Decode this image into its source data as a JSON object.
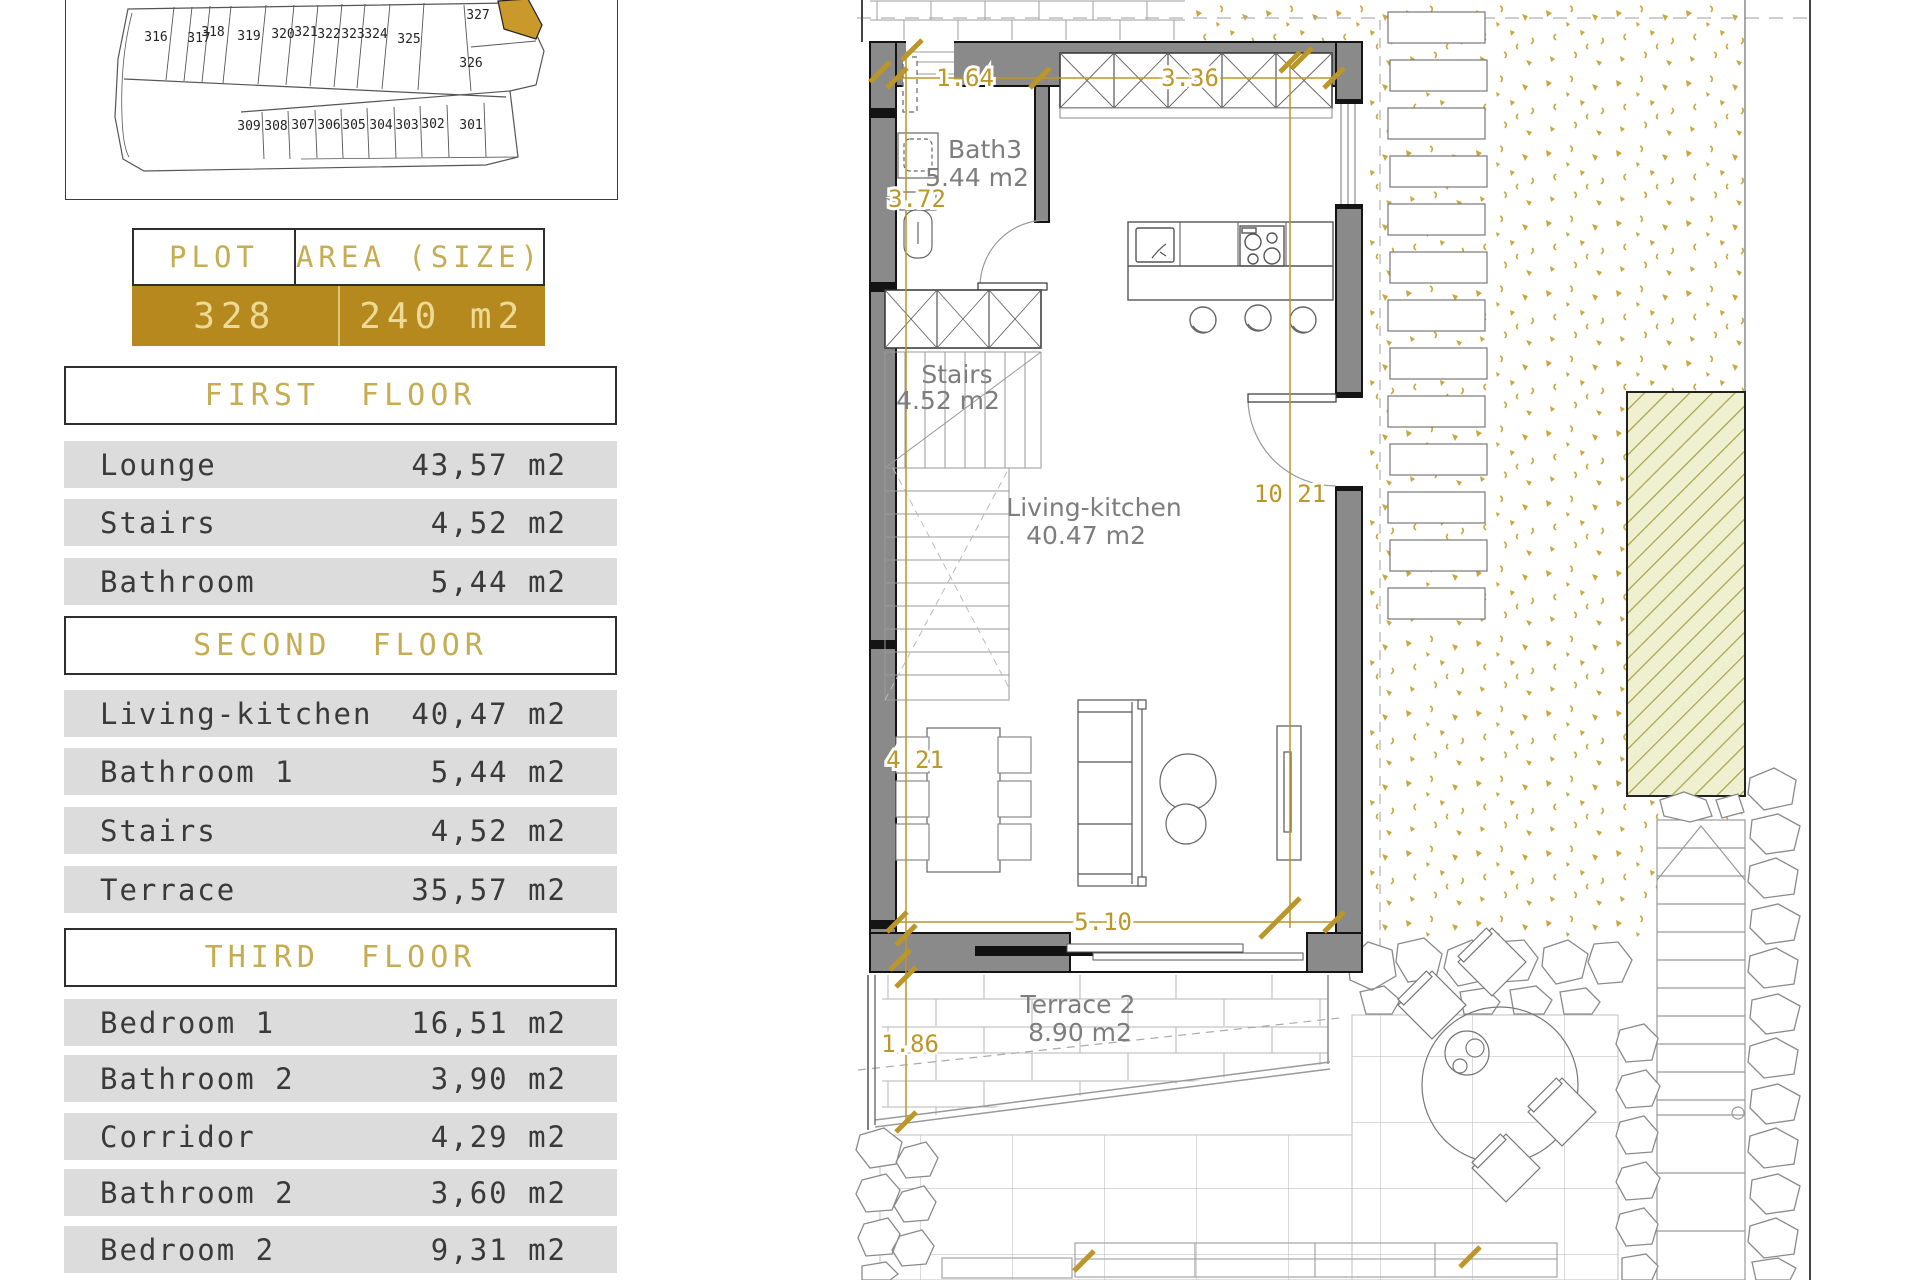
{
  "site_map": {
    "highlight_plot": "328",
    "top_row": [
      "316",
      "317",
      "318",
      "319",
      "320",
      "321",
      "322",
      "323",
      "324",
      "325"
    ],
    "upper_right": [
      "327",
      "326"
    ],
    "bottom_row": [
      "309",
      "308",
      "307",
      "306",
      "305",
      "304",
      "303",
      "302",
      "301"
    ]
  },
  "plot_table": {
    "col1_header": "PLOT",
    "col2_header": "AREA (SIZE)",
    "plot_number": "328",
    "area": "240 m2"
  },
  "floors": [
    {
      "title": "FIRST FLOOR",
      "rows": [
        {
          "name": "Lounge",
          "area": "43,57 m2"
        },
        {
          "name": "Stairs",
          "area": "4,52 m2"
        },
        {
          "name": "Bathroom",
          "area": "5,44 m2"
        }
      ]
    },
    {
      "title": "SECOND FLOOR",
      "rows": [
        {
          "name": "Living-kitchen",
          "area": "40,47 m2"
        },
        {
          "name": "Bathroom 1",
          "area": "5,44 m2"
        },
        {
          "name": "Stairs",
          "area": "4,52 m2"
        },
        {
          "name": "Terrace",
          "area": "35,57 m2"
        }
      ]
    },
    {
      "title": "THIRD FLOOR",
      "rows": [
        {
          "name": "Bedroom 1",
          "area": "16,51 m2"
        },
        {
          "name": "Bathroom 2",
          "area": "3,90 m2"
        },
        {
          "name": "Corridor",
          "area": "4,29 m2"
        },
        {
          "name": "Bathroom 2",
          "area": "3,60 m2"
        },
        {
          "name": "Bedroom 2",
          "area": "9,31 m2"
        }
      ]
    }
  ],
  "plan": {
    "rooms": [
      {
        "name": "Bath3",
        "area": "5.44 m2"
      },
      {
        "name": "Stairs",
        "area": "4.52 m2"
      },
      {
        "name": "Living-kitchen",
        "area": "40.47 m2"
      },
      {
        "name": "Terrace 2",
        "area": "8.90 m2"
      }
    ],
    "dimensions": {
      "d164": "1.64",
      "d336": "3.36",
      "d372": "3.72",
      "d1021": "10 21",
      "d421": "4 21",
      "d510": "5.10",
      "d186": "1.86"
    }
  },
  "colors": {
    "accent_row_bg": "#B5891E",
    "accent_row_text": "#EDDA96",
    "header_gold": "#C6AC52",
    "dimension_gold": "#BB9628",
    "gravel_speckle": "#C9A63E",
    "row_gray": "#DCDCDC",
    "wall_gray": "#8A8A8A",
    "label_gray": "#7D7D7D"
  }
}
